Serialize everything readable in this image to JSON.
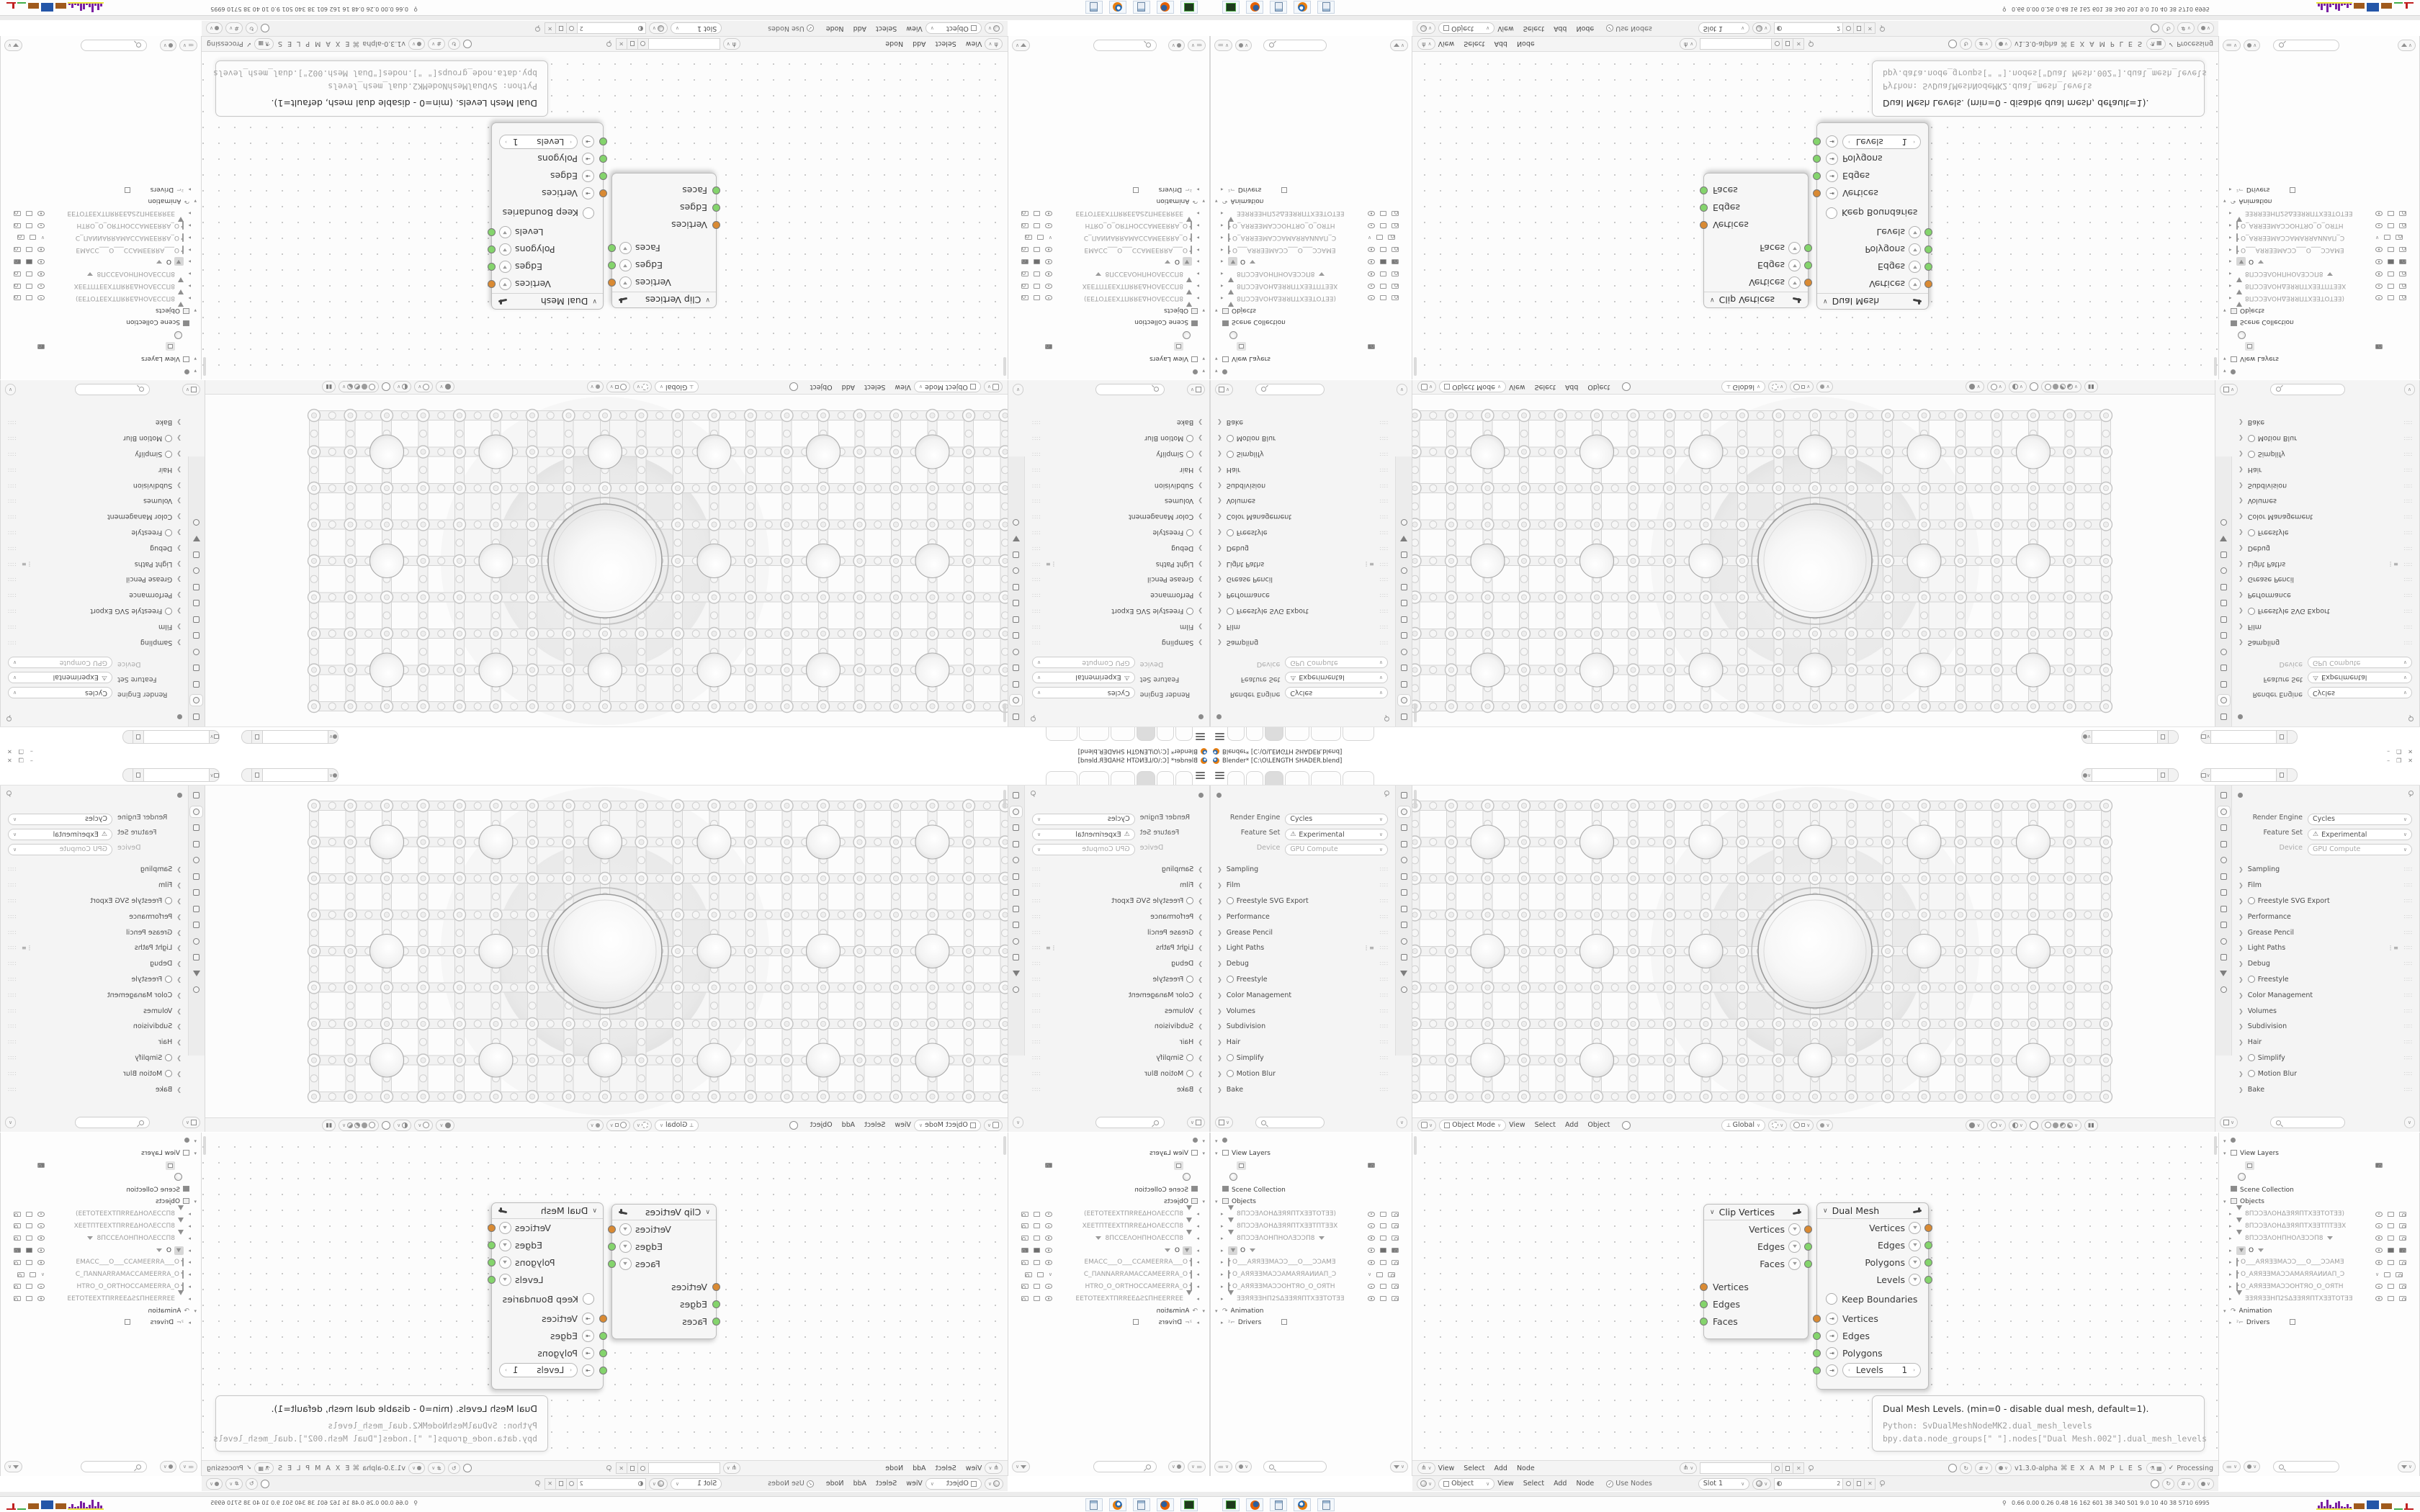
{
  "window": {
    "title": "Blender* [C:\\O\\LENGTH SHADER.blend]",
    "minimize": "–",
    "maximize": "❐",
    "close": "✕"
  },
  "topbar": {
    "new_tab": "+",
    "tabs": [
      {
        "w": 24
      },
      {
        "w": 24
      },
      {
        "w": 26,
        "active": true
      },
      {
        "w": 34
      },
      {
        "w": 42
      },
      {
        "w": 44
      }
    ],
    "scene_value": "",
    "view_layer_value": ""
  },
  "properties": {
    "engine_rows": [
      {
        "label": "Render Engine",
        "value": "Cycles",
        "warn": false,
        "grey": false
      },
      {
        "label": "Feature Set",
        "value": "Experimental",
        "warn": true,
        "grey": false
      },
      {
        "label": "Device",
        "value": "GPU Compute",
        "warn": false,
        "grey": true
      }
    ],
    "sections": [
      {
        "label": "Sampling"
      },
      {
        "label": "Film"
      },
      {
        "label": "Freestyle SVG Export",
        "toggle": true
      },
      {
        "label": "Performance"
      },
      {
        "label": "Grease Pencil"
      },
      {
        "label": "Light Paths",
        "extra": true
      },
      {
        "label": "Debug"
      },
      {
        "label": "Freestyle",
        "toggle": true
      },
      {
        "label": "Color Management"
      },
      {
        "label": "Volumes"
      },
      {
        "label": "Subdivision"
      },
      {
        "label": "Hair"
      },
      {
        "label": "Simplify",
        "toggle": true
      },
      {
        "label": "Motion Blur",
        "toggle": true
      },
      {
        "label": "Bake"
      }
    ],
    "tab_icons": [
      "tool",
      "render",
      "output",
      "view-layer",
      "scene",
      "world",
      "object",
      "modifiers",
      "particles",
      "physics",
      "constraints",
      "object-data",
      "material"
    ],
    "active_tab": "render"
  },
  "viewport": {
    "mode": "Object Mode",
    "menus": [
      "View",
      "Select",
      "Add",
      "Object"
    ],
    "orientation": "Global"
  },
  "outliner": {
    "view_layers": "View Layers",
    "scene_collection": "Scene Collection",
    "objects_label": "Objects",
    "animation": "Animation",
    "drivers": "Drivers",
    "objects": [
      {
        "type": "mesh",
        "name": "8ПƆƆƎΛOHΔƎЯЯПTXƎƎTOTƎƎ)"
      },
      {
        "type": "mesh",
        "name": "8ПƆƆƎΛOHΔƎЯЯПTXƎƎTПTƎƎX"
      },
      {
        "type": "mesh",
        "name": "8ПƆƆƎΛOHПHOΛƎƆƆП8",
        "funnel": true
      },
      {
        "type": "mesh",
        "name": "O",
        "active": true,
        "funnel": true
      },
      {
        "type": "cam",
        "name": "O___AЯЯƎƎMAƆƆ___O___ƆƆAMƎ"
      },
      {
        "type": "cam",
        "name": "O_AЯЯƎƎMAƆƆAMAЯЯAИИAП_Ɔ",
        "closed": true
      },
      {
        "type": "cam",
        "name": "O_AЯЯƎƎMAƆƆOHTЯO_O_OЯTH"
      },
      {
        "type": "mesh",
        "name": "ƎƎЯЯƎƎHП2SΔƎƎЯЯПTXƎƎTOTƎƎ"
      }
    ]
  },
  "node_editor": {
    "menus": [
      "View",
      "Select",
      "Add",
      "Node"
    ],
    "version": "v1.3.0-alpha",
    "examples": "E X A M P L E S",
    "processing": "Processing",
    "check": "✓",
    "tree_name": "",
    "clip_node": {
      "title": "Clip Vertices",
      "outputs": [
        {
          "label": "Vertices",
          "color": "#d98a33"
        },
        {
          "label": "Edges",
          "color": "#84d46c"
        },
        {
          "label": "Faces",
          "color": "#84d46c"
        }
      ],
      "inputs": [
        {
          "label": "Vertices",
          "color": "#d98a33"
        },
        {
          "label": "Edges",
          "color": "#84d46c"
        },
        {
          "label": "Faces",
          "color": "#84d46c"
        }
      ]
    },
    "dual_node": {
      "title": "Dual Mesh",
      "outputs": [
        {
          "label": "Vertices",
          "color": "#d98a33"
        },
        {
          "label": "Edges",
          "color": "#84d46c"
        },
        {
          "label": "Polygons",
          "color": "#84d46c"
        },
        {
          "label": "Levels",
          "color": "#84d46c"
        }
      ],
      "checkbox": "Keep Boundaries",
      "inputs": [
        {
          "label": "Vertices",
          "color": "#d98a33"
        },
        {
          "label": "Edges",
          "color": "#84d46c"
        },
        {
          "label": "Polygons",
          "color": "#84d46c"
        }
      ],
      "levels_label": "Levels",
      "levels_value": "1",
      "arrow_l": "‹",
      "arrow_r": "›"
    },
    "tooltip": {
      "line1": "Dual Mesh Levels. (min=0 - disable dual mesh, default=1).",
      "line2": "Python: SvDualMeshNodeMK2.dual_mesh_levels",
      "line3": "bpy.data.node_groups[\" \"].nodes[\"Dual Mesh.002\"].dual_mesh_levels"
    }
  },
  "shader_header": {
    "object": "Object",
    "menus": [
      "View",
      "Select",
      "Add",
      "Node"
    ],
    "use_nodes": "Use Nodes",
    "slot": "Slot 1",
    "users": "2",
    "material_value": ""
  },
  "taskbar": {
    "stats": "0.66 0.00 0.26 0.48   16   162   601   38   340   501   9.0   10   40   38   5710 6995",
    "app_icons": [
      "recorder",
      "firefox",
      "calculator",
      "blender",
      "calculator-2"
    ],
    "tray_colors": {
      "hist": "#7a1fa2",
      "base": "#e8e438",
      "block1": "#a05a1c",
      "block2": "#2456a8",
      "block3": "#a05a1c",
      "green": "#3fae4a",
      "red": "#c02020"
    }
  },
  "colors": {
    "socket_orange": "#d98a33",
    "socket_green": "#84d46c",
    "accent_blue": "#4772b3"
  }
}
